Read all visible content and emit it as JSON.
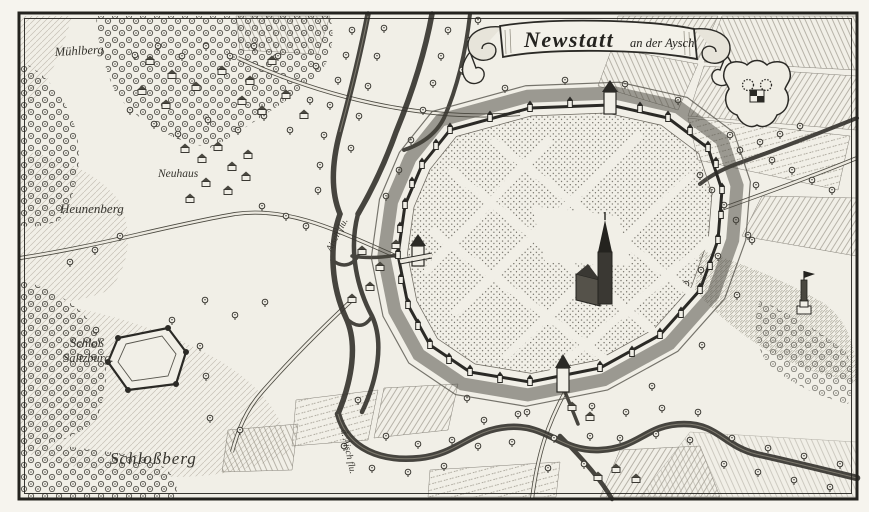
{
  "engraving": {
    "banner": {
      "title": "Newstatt",
      "subtitle": "an der Aysch."
    },
    "labels": {
      "muehlberg": "Mühlberg",
      "neuhaus": "Neuhaus",
      "heunenberg": "Heunenberg",
      "schloss_line1": "Schloß",
      "schloss_line2": "Saltzburg.",
      "schlossberg": "Schloßberg",
      "river_upper": "Aisch flu.",
      "river_lower": "d. Aisch flu."
    },
    "colors": {
      "paper": "#f1efe7",
      "ink": "#2b2a26",
      "ink_soft": "#5e5b52",
      "water": "#33312c"
    }
  },
  "decor": {
    "trees": [
      [
        352,
        30
      ],
      [
        346,
        55
      ],
      [
        338,
        80
      ],
      [
        330,
        105
      ],
      [
        324,
        135
      ],
      [
        320,
        165
      ],
      [
        318,
        190
      ],
      [
        384,
        28
      ],
      [
        377,
        56
      ],
      [
        368,
        86
      ],
      [
        359,
        116
      ],
      [
        351,
        148
      ],
      [
        448,
        30
      ],
      [
        441,
        56
      ],
      [
        433,
        83
      ],
      [
        423,
        110
      ],
      [
        411,
        140
      ],
      [
        399,
        170
      ],
      [
        386,
        196
      ],
      [
        470,
        40
      ],
      [
        462,
        70
      ],
      [
        478,
        20
      ],
      [
        505,
        88
      ],
      [
        565,
        80
      ],
      [
        625,
        84
      ],
      [
        678,
        100
      ],
      [
        730,
        135
      ],
      [
        756,
        185
      ],
      [
        752,
        240
      ],
      [
        737,
        295
      ],
      [
        702,
        345
      ],
      [
        652,
        386
      ],
      [
        592,
        406
      ],
      [
        527,
        412
      ],
      [
        467,
        398
      ],
      [
        358,
        400
      ],
      [
        386,
        436
      ],
      [
        418,
        444
      ],
      [
        452,
        440
      ],
      [
        484,
        420
      ],
      [
        518,
        414
      ],
      [
        554,
        438
      ],
      [
        590,
        436
      ],
      [
        626,
        412
      ],
      [
        662,
        408
      ],
      [
        698,
        412
      ],
      [
        732,
        438
      ],
      [
        768,
        448
      ],
      [
        804,
        456
      ],
      [
        840,
        464
      ],
      [
        344,
        446
      ],
      [
        372,
        468
      ],
      [
        408,
        472
      ],
      [
        444,
        466
      ],
      [
        478,
        446
      ],
      [
        512,
        442
      ],
      [
        548,
        468
      ],
      [
        584,
        464
      ],
      [
        620,
        438
      ],
      [
        656,
        434
      ],
      [
        690,
        440
      ],
      [
        724,
        464
      ],
      [
        758,
        472
      ],
      [
        794,
        480
      ],
      [
        830,
        487
      ],
      [
        700,
        175
      ],
      [
        712,
        190
      ],
      [
        724,
        205
      ],
      [
        736,
        220
      ],
      [
        748,
        235
      ],
      [
        718,
        256
      ],
      [
        701,
        270
      ],
      [
        686,
        284
      ],
      [
        772,
        160
      ],
      [
        792,
        170
      ],
      [
        812,
        180
      ],
      [
        832,
        190
      ],
      [
        135,
        55
      ],
      [
        158,
        46
      ],
      [
        182,
        56
      ],
      [
        206,
        46
      ],
      [
        230,
        56
      ],
      [
        254,
        46
      ],
      [
        278,
        56
      ],
      [
        130,
        110
      ],
      [
        154,
        124
      ],
      [
        178,
        134
      ],
      [
        208,
        120
      ],
      [
        238,
        130
      ],
      [
        264,
        116
      ],
      [
        290,
        130
      ],
      [
        310,
        100
      ],
      [
        316,
        66
      ],
      [
        120,
        236
      ],
      [
        95,
        250
      ],
      [
        70,
        262
      ],
      [
        262,
        206
      ],
      [
        286,
        216
      ],
      [
        306,
        226
      ],
      [
        205,
        300
      ],
      [
        235,
        315
      ],
      [
        265,
        302
      ],
      [
        172,
        320
      ],
      [
        96,
        330
      ],
      [
        200,
        346
      ],
      [
        206,
        376
      ],
      [
        240,
        430
      ],
      [
        210,
        418
      ],
      [
        740,
        150
      ],
      [
        760,
        142
      ],
      [
        780,
        134
      ],
      [
        800,
        126
      ]
    ],
    "houses": [
      [
        185,
        150
      ],
      [
        202,
        160
      ],
      [
        218,
        148
      ],
      [
        232,
        168
      ],
      [
        248,
        156
      ],
      [
        206,
        184
      ],
      [
        190,
        200
      ],
      [
        228,
        192
      ],
      [
        246,
        178
      ],
      [
        150,
        62
      ],
      [
        172,
        76
      ],
      [
        196,
        88
      ],
      [
        222,
        72
      ],
      [
        250,
        82
      ],
      [
        272,
        62
      ],
      [
        242,
        102
      ],
      [
        262,
        112
      ],
      [
        286,
        96
      ],
      [
        304,
        116
      ],
      [
        166,
        106
      ],
      [
        142,
        92
      ],
      [
        362,
        252
      ],
      [
        380,
        268
      ],
      [
        396,
        246
      ],
      [
        370,
        288
      ],
      [
        352,
        300
      ],
      [
        572,
        408
      ],
      [
        590,
        418
      ],
      [
        616,
        470
      ],
      [
        636,
        480
      ],
      [
        598,
        478
      ]
    ],
    "wall_towers": [
      [
        450,
        130
      ],
      [
        530,
        108
      ],
      [
        610,
        105
      ],
      [
        668,
        118
      ],
      [
        708,
        148
      ],
      [
        722,
        190
      ],
      [
        718,
        240
      ],
      [
        700,
        290
      ],
      [
        660,
        335
      ],
      [
        600,
        368
      ],
      [
        530,
        382
      ],
      [
        470,
        372
      ],
      [
        430,
        345
      ],
      [
        408,
        305
      ],
      [
        398,
        255
      ],
      [
        405,
        205
      ],
      [
        422,
        165
      ],
      [
        490,
        118
      ],
      [
        570,
        104
      ],
      [
        640,
        109
      ],
      [
        690,
        131
      ],
      [
        716,
        164
      ],
      [
        721,
        215
      ],
      [
        710,
        266
      ],
      [
        681,
        314
      ],
      [
        632,
        353
      ],
      [
        565,
        377
      ],
      [
        500,
        379
      ],
      [
        449,
        360
      ],
      [
        418,
        326
      ],
      [
        401,
        280
      ],
      [
        400,
        229
      ],
      [
        412,
        184
      ],
      [
        436,
        146
      ]
    ]
  }
}
